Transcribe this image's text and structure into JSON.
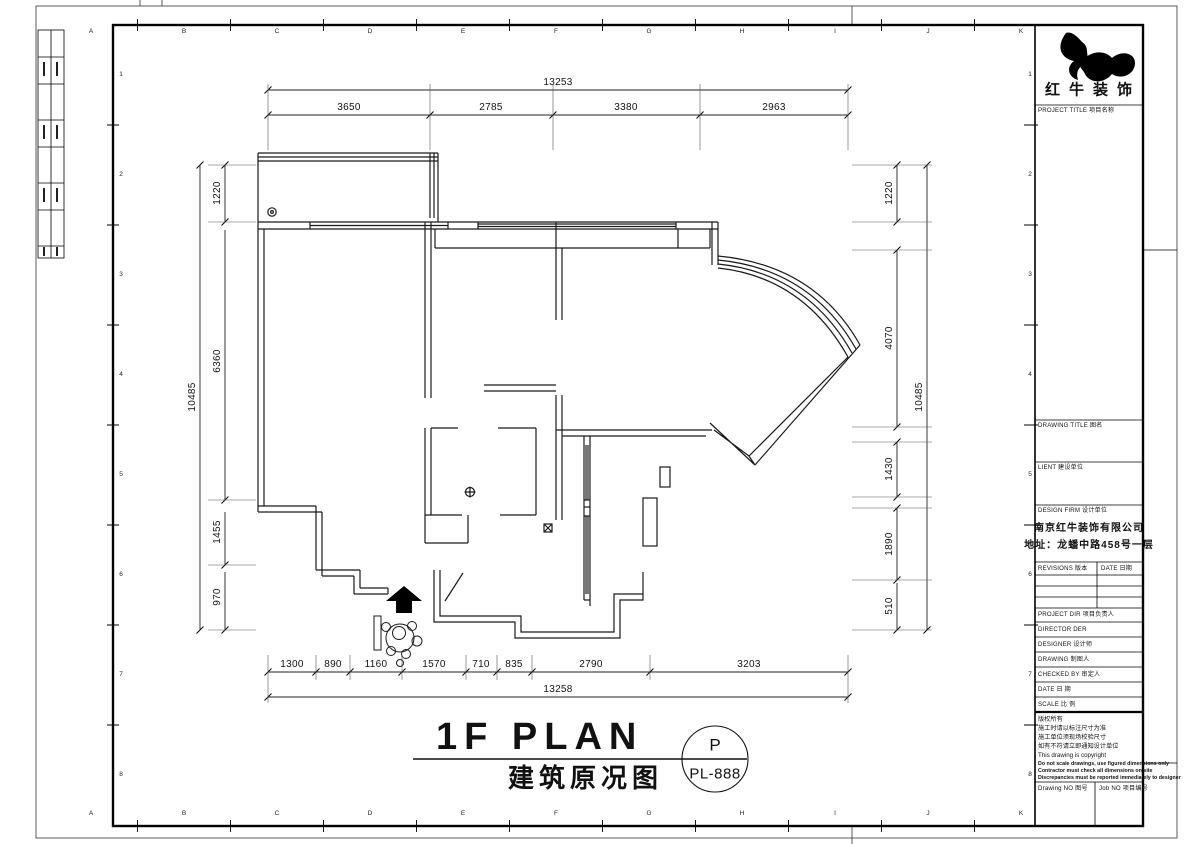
{
  "logo": {
    "name": "红牛装饰"
  },
  "plan": {
    "title": "1F PLAN",
    "subtitle": "建筑原况图",
    "bubble_top": "P",
    "bubble_bottom": "PL-888"
  },
  "dimensions": {
    "top_total": "13253",
    "top_segments": [
      "3650",
      "2785",
      "3380",
      "2963"
    ],
    "bottom_segments": [
      "1300",
      "890",
      "1160",
      "1570",
      "710",
      "835",
      "2790",
      "3203"
    ],
    "bottom_total": "13258",
    "left_total": "10485",
    "left_segments": [
      "1220",
      "6360",
      "1455",
      "970"
    ],
    "right_total": "10485",
    "right_segments": [
      "1220",
      "4070",
      "1430",
      "1890",
      "510"
    ]
  },
  "grid": {
    "columns": [
      "A",
      "B",
      "C",
      "D",
      "E",
      "F",
      "G",
      "H",
      "I",
      "J",
      "K"
    ],
    "rows": [
      "1",
      "2",
      "3",
      "4",
      "5",
      "6",
      "7",
      "8"
    ]
  },
  "title_block": {
    "project_title": "PROJECT TITLE  项目名称",
    "drawing_title": "DRAWING TITLE  图名",
    "client": "LIENT  建设单位",
    "design_firm": "DESIGN FIRM  设计单位",
    "company": "南京红牛装饰有限公司",
    "address": "地址：龙蟠中路458号一层",
    "revisions": "REVISIONS  版本",
    "date_col": "DATE  日期",
    "project_dir": "PROJECT DIR   项目负责人",
    "director": "DIRECTOR DER",
    "designer": "DESIGNER    设计师",
    "drawing": "DRAWING    制图人",
    "checked_by": "CHECKED BY   审定人",
    "date": "DATE      日 期",
    "scale": "SCALE     比 例",
    "notes": [
      "版权所有",
      "施工时请以标注尺寸为准",
      "施工单位须现场校验尺寸",
      "如有不符请立即通知设计单位",
      "This drawing is copyright"
    ],
    "notes_bold": [
      "Do not scale drawings, use figured dimensions only",
      "Contractor must check all dimensions on site",
      "Discrepancies must be reported immediately to designer"
    ],
    "drawing_no": "Drawing NO  图号",
    "job_no": "Job NO  项目编号"
  }
}
